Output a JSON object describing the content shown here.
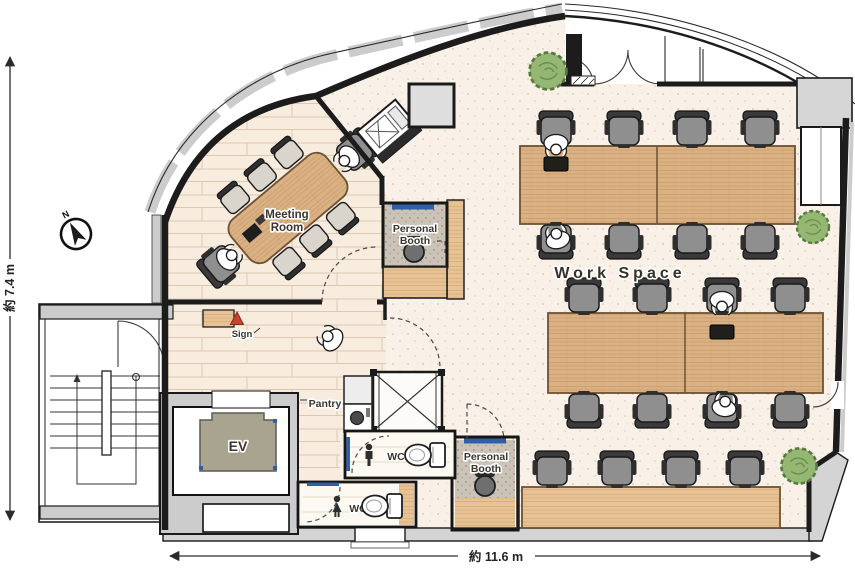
{
  "title": "Office floor plan",
  "labels": {
    "meeting_room": [
      "Meeting",
      "Room"
    ],
    "personal_booth": [
      "Personal",
      "Booth"
    ],
    "work_space": "Work Space",
    "pantry": "Pantry",
    "elevator": "EV",
    "wc": "WC",
    "sign": "Sign",
    "north": "N"
  },
  "dimensions": {
    "width_label": "約 11.6 m",
    "height_label": "約 7.4 m"
  },
  "colors": {
    "wall": "#1c1c1c",
    "wood": "#dab184",
    "wood_bright": "#e6c294",
    "floor": "#f9f1e7",
    "plank": "#f8ecdf",
    "carpet": "#cbc3b7",
    "chair": "#8f8f8f",
    "ev_car": "#a9a48f",
    "plant": "#94b873",
    "blue": "#2f5fa8",
    "red": "#c7432e",
    "eave": "#cccccc"
  },
  "furniture": {
    "desk_banks": 3,
    "workspace_chairs": 20,
    "meeting_side_chairs": 6,
    "meeting_task_chairs": 2,
    "personal_booths": 2,
    "toilets": 2,
    "plants": 3,
    "people_visible": 7
  }
}
